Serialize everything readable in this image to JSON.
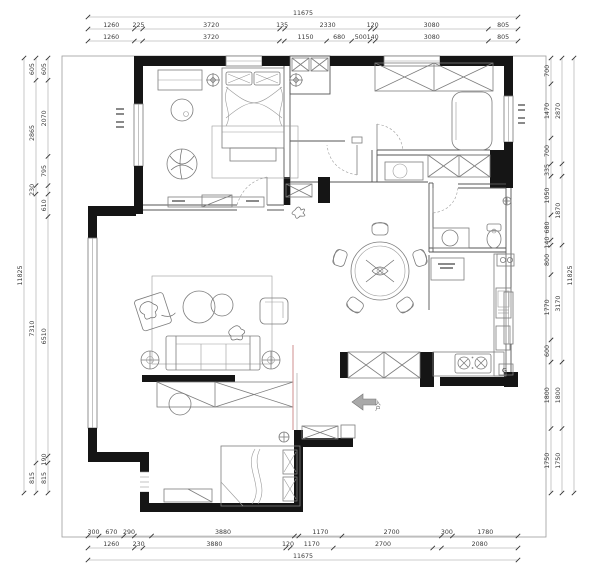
{
  "plan": {
    "entry_label": "入户",
    "gas_meter_label": "G"
  },
  "dims": {
    "top": {
      "overall": [
        {
          "v": 11675,
          "t": "11675"
        }
      ],
      "row1": [
        {
          "v": 1260,
          "t": "1260"
        },
        {
          "v": 225,
          "t": "225"
        },
        {
          "v": 3720,
          "t": "3720"
        },
        {
          "v": 135,
          "t": "135"
        },
        {
          "v": 2330,
          "t": "2330"
        },
        {
          "v": 120,
          "t": "120"
        },
        {
          "v": 3080,
          "t": "3080"
        },
        {
          "v": 805,
          "t": "805"
        }
      ],
      "row2": [
        {
          "v": 1260,
          "t": "1260"
        },
        {
          "v": 225,
          "t": ""
        },
        {
          "v": 3720,
          "t": "3720"
        },
        {
          "v": 135,
          "t": ""
        },
        {
          "v": 1150,
          "t": "1150"
        },
        {
          "v": 680,
          "t": "680"
        },
        {
          "v": 500,
          "t": "500"
        },
        {
          "v": 140,
          "t": "140"
        },
        {
          "v": 3080,
          "t": "3080"
        },
        {
          "v": 805,
          "t": "805"
        }
      ]
    },
    "bottom": {
      "row1": [
        {
          "v": 300,
          "t": "300"
        },
        {
          "v": 670,
          "t": "670"
        },
        {
          "v": 290,
          "t": "290"
        },
        {
          "v": 465,
          "t": ""
        },
        {
          "v": 3880,
          "t": "3880"
        },
        {
          "v": 120,
          "t": ""
        },
        {
          "v": 1170,
          "t": "1170"
        },
        {
          "v": 2700,
          "t": "2700"
        },
        {
          "v": 300,
          "t": "300"
        },
        {
          "v": 1780,
          "t": "1780"
        }
      ],
      "row2": [
        {
          "v": 1260,
          "t": "1260"
        },
        {
          "v": 230,
          "t": "230"
        },
        {
          "v": 3880,
          "t": "3880"
        },
        {
          "v": 120,
          "t": "120"
        },
        {
          "v": 1170,
          "t": "1170"
        },
        {
          "v": 2700,
          "t": "2700"
        },
        {
          "v": 235,
          "t": ""
        },
        {
          "v": 2080,
          "t": "2080"
        }
      ],
      "overall": [
        {
          "v": 11675,
          "t": "11675"
        }
      ]
    },
    "left": {
      "inner": [
        {
          "v": 605,
          "t": "605"
        },
        {
          "v": 2070,
          "t": "2070"
        },
        {
          "v": 795,
          "t": "795"
        },
        {
          "v": 230,
          "t": ""
        },
        {
          "v": 610,
          "t": "610"
        },
        {
          "v": 6510,
          "t": "6510"
        },
        {
          "v": 190,
          "t": "190"
        },
        {
          "v": 815,
          "t": "815"
        }
      ],
      "middle": [
        {
          "v": 605,
          "t": "605"
        },
        {
          "v": 2865,
          "t": "2865"
        },
        {
          "v": 230,
          "t": "230"
        },
        {
          "v": 7310,
          "t": "7310"
        },
        {
          "v": 815,
          "t": "815"
        }
      ],
      "overall": [
        {
          "v": 11825,
          "t": "11825"
        }
      ]
    },
    "right": {
      "inner": [
        {
          "v": 700,
          "t": "700"
        },
        {
          "v": 1470,
          "t": "1470"
        },
        {
          "v": 700,
          "t": "700"
        },
        {
          "v": 335,
          "t": "335"
        },
        {
          "v": 1050,
          "t": "1050"
        },
        {
          "v": 680,
          "t": "680"
        },
        {
          "v": 140,
          "t": "140"
        },
        {
          "v": 800,
          "t": "800"
        },
        {
          "v": 1770,
          "t": "1770"
        },
        {
          "v": 600,
          "t": "600"
        },
        {
          "v": 1800,
          "t": "1800"
        },
        {
          "v": 1750,
          "t": "1750"
        }
      ],
      "middle": [
        {
          "v": 2870,
          "t": "2870"
        },
        {
          "v": 335,
          "t": ""
        },
        {
          "v": 1870,
          "t": "1870"
        },
        {
          "v": 3170,
          "t": "3170"
        },
        {
          "v": 1800,
          "t": "1800"
        },
        {
          "v": 1750,
          "t": "1750"
        }
      ],
      "overall": [
        {
          "v": 11825,
          "t": "11825"
        }
      ]
    }
  }
}
